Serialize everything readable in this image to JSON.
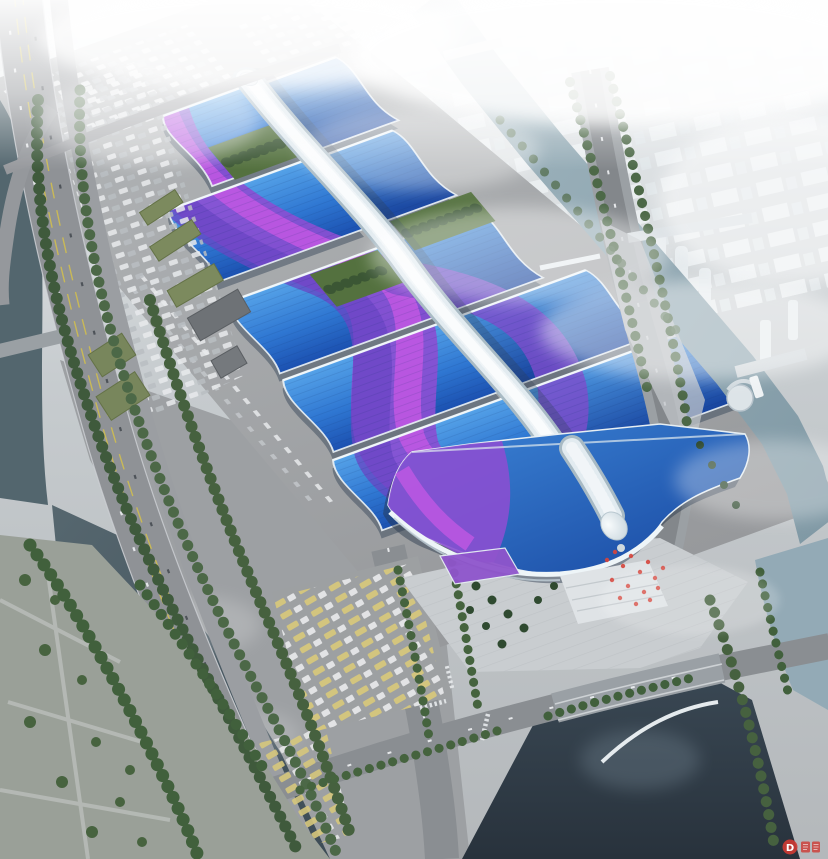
{
  "scene": {
    "type": "aerial-architectural-rendering",
    "subject": "Large exhibition & convention center complex, bird's-eye view",
    "features": [
      "rows of wave-form exhibition hall roofs in blue with magenta ribbon accents",
      "white serpentine central concourse spine ending in a bulb over the south entrance hall",
      "hazy white city skyline fading into fog at top",
      "rivers and canals on left, right and bottom",
      "elevated highway on the west side",
      "parking lots with cars, trucks and buses",
      "tree-lined avenues, palm trees and entrance plaza with red flags"
    ]
  },
  "watermark": {
    "letter": "D"
  },
  "palette": {
    "roof_blue_light": "#55a2e8",
    "roof_blue_dark": "#1b50b0",
    "ribbon_magenta": "#c558e4",
    "ribbon_violet": "#6a46c4",
    "spine_white": "#e2ebf0",
    "water_dark": "#36434f",
    "water_light": "#93aab6",
    "road_grey": "#8f9296",
    "tree_green": "#4c6847",
    "haze_white": "#ffffff",
    "accent_red": "#cf3a33"
  }
}
